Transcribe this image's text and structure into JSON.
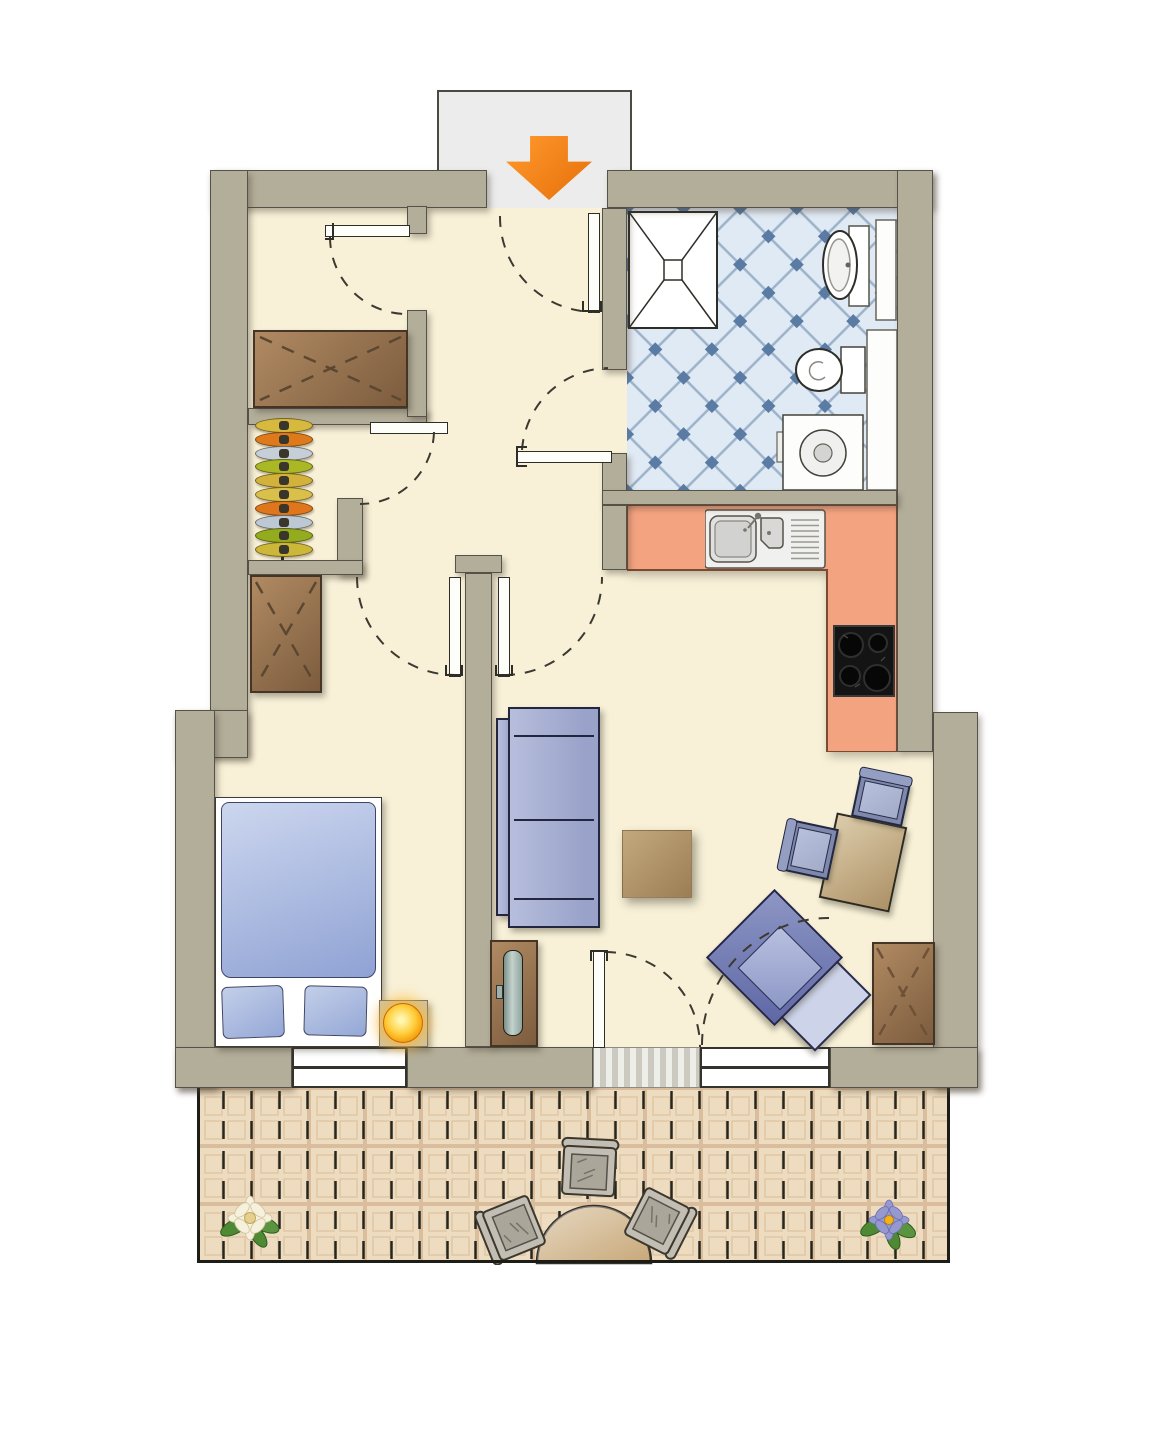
{
  "title": "Apartment floor plan (top view)",
  "plan_type": "one-room apartment with balcony",
  "palette": {
    "wall": "#b3ae9a",
    "wall_line": "#55524a",
    "floor": "#f8f1d8",
    "vestibule": "#ececec",
    "vest_line": "#4a4a42",
    "tile_base": "#e0eaf4",
    "tile_line": "#9cb2ca",
    "tile_dot": "#5a7ba3",
    "counter": "#f4a381",
    "counter_line": "#7c4a32",
    "balcony": "#eddcc0",
    "balcony_line": "#d9bd9c",
    "balcony_dash": "#26261e",
    "balcony_border": "#1d1d18",
    "arrow": "#f08018",
    "wood_light": "#b08a62",
    "wood_dark": "#7c5c3e",
    "wood_line": "#463526",
    "sofa_l": "#b7bedd",
    "sofa_d": "#99a2c9",
    "sofa_line": "#23263f",
    "chair_frame": "#7e88ad",
    "chair_cushion": "#a2acc9",
    "table_l": "#dcccab",
    "table_d": "#ad9166",
    "bal_table": "#c8a878",
    "bal_chair": "#c2beb4",
    "duvet_l": "#ccd6ee",
    "duvet_d": "#8fa2d4",
    "arc_line": "#3c3a30"
  },
  "rooms": [
    {
      "id": "entry",
      "items": [
        "entrance-arrow",
        "vestibule",
        "entrance-door"
      ]
    },
    {
      "id": "hall",
      "items": [
        "closet-wardrobe",
        "coat-rack",
        "hall-wardrobe",
        "interior-doors"
      ]
    },
    {
      "id": "bathroom",
      "items": [
        "shower",
        "washbasin",
        "toilet",
        "washing-machine",
        "niches"
      ]
    },
    {
      "id": "kitchen",
      "items": [
        "l-counter",
        "sink",
        "cooktop"
      ]
    },
    {
      "id": "bedroom",
      "items": [
        "double-bed",
        "pillows",
        "nightstand",
        "lamp",
        "wardrobe",
        "window"
      ]
    },
    {
      "id": "living-room",
      "items": [
        "sofa",
        "coffee-table",
        "tv-lowboard",
        "tv",
        "dining-table",
        "dining-chairs",
        "armchair",
        "sideboard",
        "window",
        "balcony-door"
      ]
    },
    {
      "id": "balcony",
      "items": [
        "bistro-table",
        "garden-chairs",
        "white-flower",
        "purple-flower"
      ]
    }
  ],
  "coat_rack": {
    "hanger_colors": [
      "#d6b93d",
      "#df7a1b",
      "#c6cfd8",
      "#a9b824",
      "#d2b23a",
      "#d8c04a",
      "#e0761c",
      "#bcc8d4",
      "#93ac1e",
      "#ccb738"
    ]
  }
}
